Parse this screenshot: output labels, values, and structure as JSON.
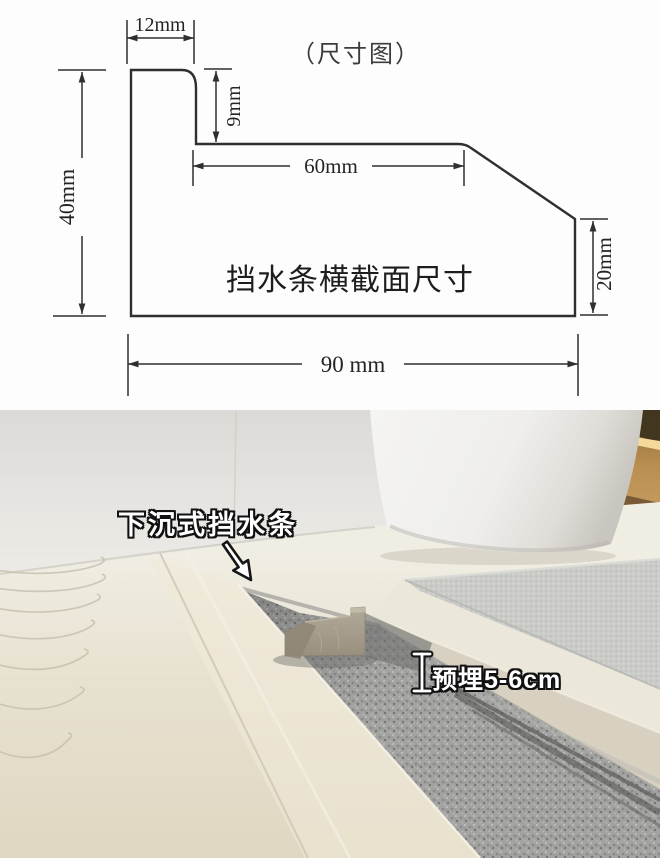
{
  "diagram": {
    "title": "（尺寸图）",
    "section_label": "挡水条横截面尺寸",
    "dims": {
      "top_width": "12mm",
      "step_height": "9mm",
      "upper_flat_width": "60mm",
      "left_height": "40mm",
      "right_height": "20mm",
      "total_width": "90 mm"
    },
    "line_color": "#2f2f2f"
  },
  "photo": {
    "callout": "下沉式挡水条",
    "embed_depth_note": "预埋5-6cm",
    "colors": {
      "floor": "#e6dfcc",
      "wall": "#e7e5e1",
      "trench_concrete": "#a3a3a1",
      "strip_sample": "#a59d8c",
      "bath_mat": "#cbccc8",
      "toilet": "#f2f1ef",
      "niche_glow": "#f5d99b",
      "niche_wood": "#b98e51",
      "label_text": "#ffffff",
      "label_outline": "#111111"
    }
  }
}
